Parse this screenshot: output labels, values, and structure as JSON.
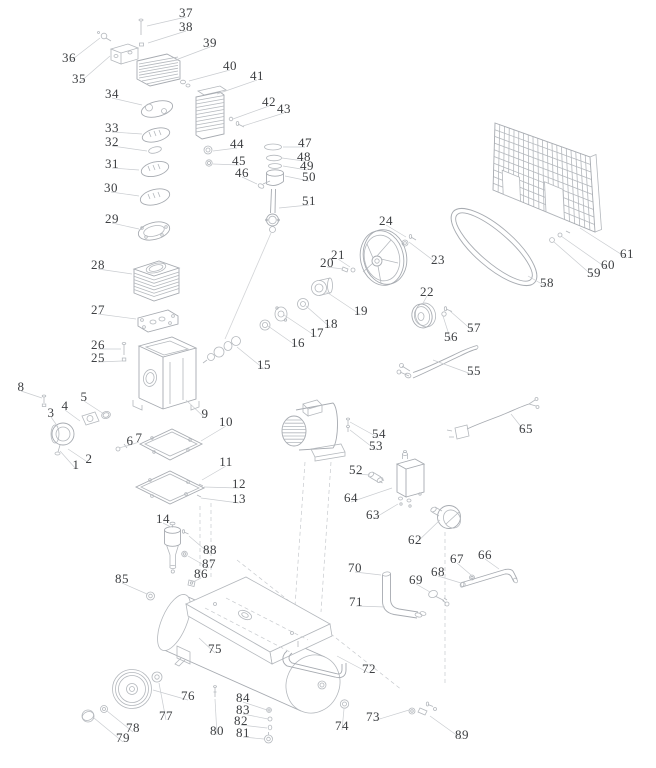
{
  "colors": {
    "background": "#ffffff",
    "drawing_line": "#b4b8bd",
    "leader_line": "#c9ccd0",
    "label_text": "#3e4043"
  },
  "diagram": {
    "labels": [
      {
        "n": "1",
        "x": 76,
        "y": 465,
        "tx": 60,
        "ty": 451
      },
      {
        "n": "2",
        "x": 89,
        "y": 459,
        "tx": 68,
        "ty": 449
      },
      {
        "n": "3",
        "x": 51,
        "y": 413,
        "tx": 58,
        "ty": 427
      },
      {
        "n": "4",
        "x": 65,
        "y": 406,
        "tx": 80,
        "ty": 421
      },
      {
        "n": "5",
        "x": 84,
        "y": 397,
        "tx": 104,
        "ty": 414
      },
      {
        "n": "6",
        "x": 130,
        "y": 441,
        "tx": 119,
        "ty": 448
      },
      {
        "n": "7",
        "x": 139,
        "y": 438,
        "tx": 127,
        "ty": 446
      },
      {
        "n": "8",
        "x": 21,
        "y": 387,
        "tx": 42,
        "ty": 398
      },
      {
        "n": "9",
        "x": 205,
        "y": 414,
        "tx": 186,
        "ty": 400
      },
      {
        "n": "10",
        "x": 226,
        "y": 422,
        "tx": 201,
        "ty": 441
      },
      {
        "n": "11",
        "x": 226,
        "y": 462,
        "tx": 202,
        "ty": 480
      },
      {
        "n": "12",
        "x": 239,
        "y": 484,
        "tx": 204,
        "ty": 487
      },
      {
        "n": "13",
        "x": 239,
        "y": 499,
        "tx": 201,
        "ty": 498
      },
      {
        "n": "14",
        "x": 163,
        "y": 519,
        "tx": 171,
        "ty": 527
      },
      {
        "n": "15",
        "x": 264,
        "y": 365,
        "tx": 237,
        "ty": 347
      },
      {
        "n": "16",
        "x": 298,
        "y": 343,
        "tx": 268,
        "ty": 326
      },
      {
        "n": "17",
        "x": 317,
        "y": 333,
        "tx": 284,
        "ty": 315
      },
      {
        "n": "18",
        "x": 331,
        "y": 324,
        "tx": 306,
        "ty": 306
      },
      {
        "n": "19",
        "x": 361,
        "y": 311,
        "tx": 325,
        "ty": 291
      },
      {
        "n": "20",
        "x": 327,
        "y": 263,
        "tx": 343,
        "ty": 269
      },
      {
        "n": "21",
        "x": 338,
        "y": 255,
        "tx": 350,
        "ty": 267
      },
      {
        "n": "22",
        "x": 427,
        "y": 292,
        "tx": 422,
        "ty": 305
      },
      {
        "n": "23",
        "x": 438,
        "y": 260,
        "tx": 409,
        "ty": 242
      },
      {
        "n": "24",
        "x": 386,
        "y": 221,
        "tx": 406,
        "ty": 237
      },
      {
        "n": "25",
        "x": 98,
        "y": 358,
        "tx": 122,
        "ty": 361
      },
      {
        "n": "26",
        "x": 98,
        "y": 345,
        "tx": 121,
        "ty": 349
      },
      {
        "n": "27",
        "x": 98,
        "y": 310,
        "tx": 136,
        "ty": 319
      },
      {
        "n": "28",
        "x": 98,
        "y": 265,
        "tx": 132,
        "ty": 274
      },
      {
        "n": "29",
        "x": 112,
        "y": 219,
        "tx": 139,
        "ty": 229
      },
      {
        "n": "30",
        "x": 111,
        "y": 188,
        "tx": 139,
        "ty": 196
      },
      {
        "n": "31",
        "x": 112,
        "y": 164,
        "tx": 139,
        "ty": 170
      },
      {
        "n": "32",
        "x": 112,
        "y": 142,
        "tx": 147,
        "ty": 151
      },
      {
        "n": "33",
        "x": 112,
        "y": 128,
        "tx": 142,
        "ty": 134
      },
      {
        "n": "34",
        "x": 112,
        "y": 94,
        "tx": 142,
        "ty": 105
      },
      {
        "n": "35",
        "x": 79,
        "y": 79,
        "tx": 110,
        "ty": 56
      },
      {
        "n": "36",
        "x": 69,
        "y": 58,
        "tx": 100,
        "ty": 38
      },
      {
        "n": "37",
        "x": 186,
        "y": 13,
        "tx": 147,
        "ty": 26
      },
      {
        "n": "38",
        "x": 186,
        "y": 27,
        "tx": 148,
        "ty": 43
      },
      {
        "n": "39",
        "x": 210,
        "y": 43,
        "tx": 173,
        "ty": 61
      },
      {
        "n": "40",
        "x": 230,
        "y": 66,
        "tx": 189,
        "ty": 81
      },
      {
        "n": "41",
        "x": 257,
        "y": 76,
        "tx": 217,
        "ty": 94
      },
      {
        "n": "42",
        "x": 269,
        "y": 102,
        "tx": 233,
        "ty": 119
      },
      {
        "n": "43",
        "x": 284,
        "y": 109,
        "tx": 243,
        "ty": 126
      },
      {
        "n": "44",
        "x": 237,
        "y": 144,
        "tx": 213,
        "ty": 151
      },
      {
        "n": "45",
        "x": 239,
        "y": 161,
        "tx": 213,
        "ty": 164
      },
      {
        "n": "46",
        "x": 242,
        "y": 173,
        "tx": 257,
        "ty": 184
      },
      {
        "n": "47",
        "x": 305,
        "y": 143,
        "tx": 283,
        "ty": 147
      },
      {
        "n": "48",
        "x": 304,
        "y": 157,
        "tx": 282,
        "ty": 158
      },
      {
        "n": "49",
        "x": 307,
        "y": 166,
        "tx": 283,
        "ty": 166
      },
      {
        "n": "50",
        "x": 309,
        "y": 177,
        "tx": 285,
        "ty": 176
      },
      {
        "n": "51",
        "x": 309,
        "y": 201,
        "tx": 279,
        "ty": 208
      },
      {
        "n": "52",
        "x": 356,
        "y": 470,
        "tx": 370,
        "ty": 475
      },
      {
        "n": "53",
        "x": 376,
        "y": 446,
        "tx": 350,
        "ty": 430
      },
      {
        "n": "54",
        "x": 379,
        "y": 434,
        "tx": 350,
        "ty": 422
      },
      {
        "n": "55",
        "x": 474,
        "y": 371,
        "tx": 433,
        "ty": 360
      },
      {
        "n": "56",
        "x": 451,
        "y": 337,
        "tx": 443,
        "ty": 316
      },
      {
        "n": "57",
        "x": 474,
        "y": 328,
        "tx": 450,
        "ty": 311
      },
      {
        "n": "58",
        "x": 547,
        "y": 283,
        "tx": 528,
        "ty": 276
      },
      {
        "n": "59",
        "x": 594,
        "y": 273,
        "tx": 554,
        "ty": 242
      },
      {
        "n": "60",
        "x": 608,
        "y": 265,
        "tx": 561,
        "ty": 236
      },
      {
        "n": "61",
        "x": 627,
        "y": 254,
        "tx": 580,
        "ty": 228
      },
      {
        "n": "62",
        "x": 415,
        "y": 540,
        "tx": 440,
        "ty": 520
      },
      {
        "n": "63",
        "x": 373,
        "y": 515,
        "tx": 398,
        "ty": 504
      },
      {
        "n": "64",
        "x": 351,
        "y": 498,
        "tx": 392,
        "ty": 488
      },
      {
        "n": "65",
        "x": 526,
        "y": 429,
        "tx": 511,
        "ty": 414
      },
      {
        "n": "66",
        "x": 485,
        "y": 555,
        "tx": 499,
        "ty": 569
      },
      {
        "n": "67",
        "x": 457,
        "y": 559,
        "tx": 471,
        "ty": 575
      },
      {
        "n": "68",
        "x": 438,
        "y": 572,
        "tx": 461,
        "ty": 583
      },
      {
        "n": "69",
        "x": 416,
        "y": 580,
        "tx": 430,
        "ty": 592
      },
      {
        "n": "70",
        "x": 355,
        "y": 568,
        "tx": 381,
        "ty": 575
      },
      {
        "n": "71",
        "x": 356,
        "y": 602,
        "tx": 385,
        "ty": 607
      },
      {
        "n": "72",
        "x": 369,
        "y": 669,
        "tx": 337,
        "ty": 656
      },
      {
        "n": "73",
        "x": 373,
        "y": 717,
        "tx": 409,
        "ty": 710
      },
      {
        "n": "74",
        "x": 342,
        "y": 726,
        "tx": 344,
        "ty": 709
      },
      {
        "n": "75",
        "x": 215,
        "y": 649,
        "tx": 199,
        "ty": 638
      },
      {
        "n": "76",
        "x": 188,
        "y": 696,
        "tx": 153,
        "ty": 690
      },
      {
        "n": "77",
        "x": 166,
        "y": 716,
        "tx": 159,
        "ty": 683
      },
      {
        "n": "78",
        "x": 133,
        "y": 728,
        "tx": 107,
        "ty": 711
      },
      {
        "n": "79",
        "x": 123,
        "y": 738,
        "tx": 94,
        "ty": 718
      },
      {
        "n": "80",
        "x": 217,
        "y": 731,
        "tx": 215,
        "ty": 699
      },
      {
        "n": "81",
        "x": 243,
        "y": 733,
        "tx": 264,
        "ty": 739
      },
      {
        "n": "82",
        "x": 241,
        "y": 721,
        "tx": 267,
        "ty": 728
      },
      {
        "n": "83",
        "x": 243,
        "y": 710,
        "tx": 268,
        "ty": 719
      },
      {
        "n": "84",
        "x": 243,
        "y": 698,
        "tx": 267,
        "ty": 710
      },
      {
        "n": "85",
        "x": 122,
        "y": 579,
        "tx": 147,
        "ty": 594
      },
      {
        "n": "86",
        "x": 201,
        "y": 574,
        "tx": 193,
        "ty": 582
      },
      {
        "n": "87",
        "x": 209,
        "y": 564,
        "tx": 188,
        "ty": 556
      },
      {
        "n": "88",
        "x": 210,
        "y": 550,
        "tx": 189,
        "ty": 536
      },
      {
        "n": "89",
        "x": 462,
        "y": 735,
        "tx": 430,
        "ty": 716
      }
    ]
  }
}
